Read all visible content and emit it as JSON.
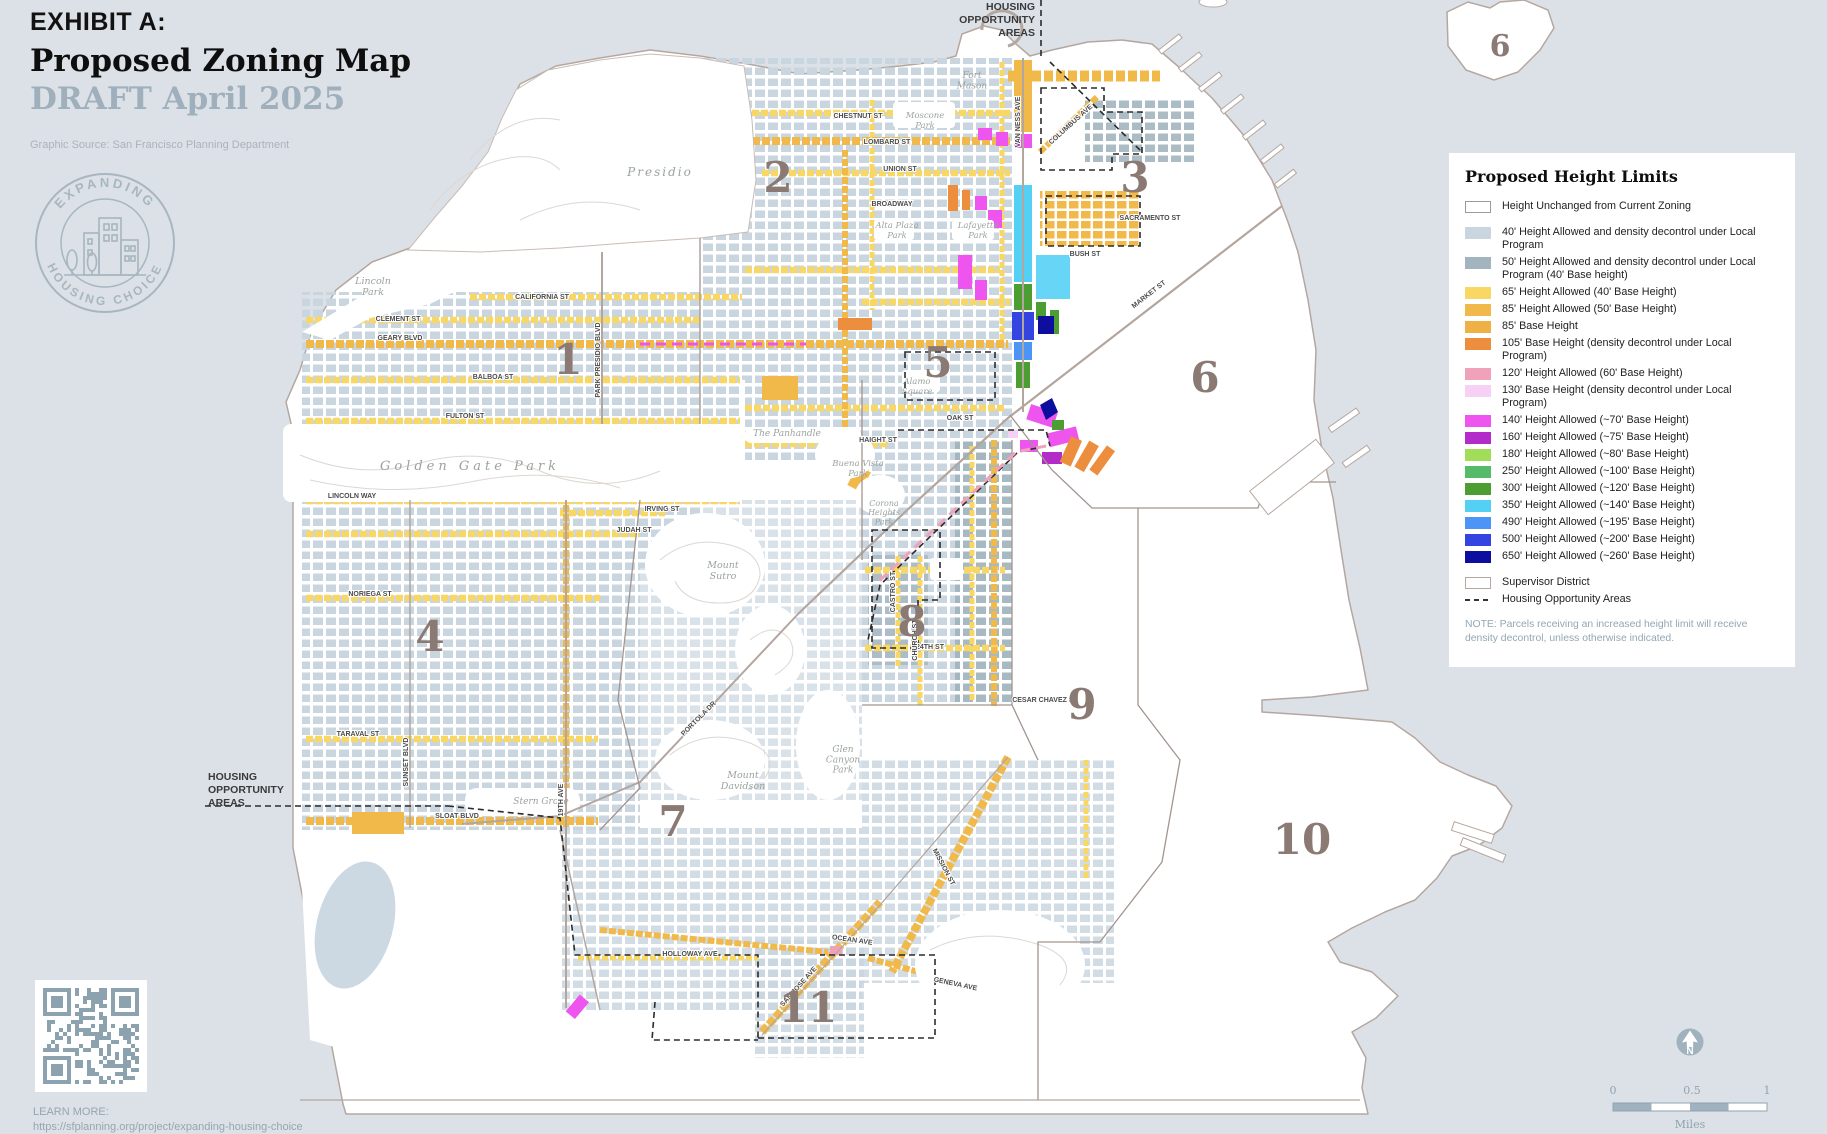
{
  "header": {
    "exhibit": "EXHIBIT A:",
    "title": "Proposed Zoning Map",
    "draft": "DRAFT April 2025",
    "source": "Graphic Source: San Francisco Planning Department"
  },
  "logo": {
    "top": "EXPANDING",
    "bottom": "HOUSING CHOICE"
  },
  "colors": {
    "water": "#dce1e7",
    "land": "#ffffff",
    "boundary": "#a3948e",
    "district_number": "#8a7a73",
    "draft_text": "#9fb0bc"
  },
  "legend": {
    "title": "Proposed Height Limits",
    "items": [
      {
        "label": "Height Unchanged from Current Zoning",
        "swatch": "outline",
        "color": "#ffffff",
        "gap_after": true
      },
      {
        "label": "40' Height Allowed and density decontrol under Local Program",
        "swatch": "fill",
        "color": "#c9d6e0"
      },
      {
        "label": "50' Height Allowed and density decontrol under Local Program (40' Base height)",
        "swatch": "fill",
        "color": "#a2b5bf"
      },
      {
        "label": "65' Height Allowed (40' Base Height)",
        "swatch": "fill",
        "color": "#f9d765"
      },
      {
        "label": "85' Height Allowed (50' Base Height)",
        "swatch": "fill",
        "color": "#f0b94a"
      },
      {
        "label": "85' Base Height",
        "swatch": "fill",
        "color": "#efb045"
      },
      {
        "label": "105' Base Height (density decontrol under Local Program)",
        "swatch": "fill",
        "color": "#ec8e3d"
      },
      {
        "label": "120' Height Allowed (60' Base Height)",
        "swatch": "fill",
        "color": "#f0a2ba"
      },
      {
        "label": "130' Base Height (density decontrol under Local Program)",
        "swatch": "fill",
        "color": "#f6d0f5"
      },
      {
        "label": "140' Height Allowed (~70' Base Height)",
        "swatch": "fill",
        "color": "#ee55ee"
      },
      {
        "label": "160' Height Allowed (~75' Base Height)",
        "swatch": "fill",
        "color": "#b32bc9"
      },
      {
        "label": "180' Height Allowed (~80' Base Height)",
        "swatch": "fill",
        "color": "#a2dd59"
      },
      {
        "label": "250' Height Allowed (~100' Base Height)",
        "swatch": "fill",
        "color": "#55bb6b"
      },
      {
        "label": "300' Height Allowed (~120' Base Height)",
        "swatch": "fill",
        "color": "#4d9e32"
      },
      {
        "label": "350' Height Allowed (~140' Base Height)",
        "swatch": "fill",
        "color": "#55d0f5"
      },
      {
        "label": "490' Height Allowed (~195' Base Height)",
        "swatch": "fill",
        "color": "#4d94f7"
      },
      {
        "label": "500' Height Allowed (~200' Base Height)",
        "swatch": "fill",
        "color": "#3444e0"
      },
      {
        "label": "650' Height Allowed (~260' Base Height)",
        "swatch": "fill",
        "color": "#0d0d9e",
        "gap_after": true
      },
      {
        "label": "Supervisor District",
        "swatch": "outline-brown",
        "color": "#ffffff"
      },
      {
        "label": "Housing Opportunity Areas",
        "swatch": "dash",
        "color": "#333333"
      }
    ],
    "note": "NOTE: Parcels receiving an increased height limit will receive density decontrol, unless otherwise indicated."
  },
  "districts": [
    {
      "n": "1",
      "x": 568,
      "y": 374
    },
    {
      "n": "2",
      "x": 778,
      "y": 192
    },
    {
      "n": "3",
      "x": 1135,
      "y": 192
    },
    {
      "n": "4",
      "x": 430,
      "y": 651
    },
    {
      "n": "5",
      "x": 938,
      "y": 377
    },
    {
      "n": "6",
      "x": 1205,
      "y": 392
    },
    {
      "n": "7",
      "x": 673,
      "y": 836
    },
    {
      "n": "8",
      "x": 912,
      "y": 636
    },
    {
      "n": "9",
      "x": 1082,
      "y": 719
    },
    {
      "n": "10",
      "x": 1302,
      "y": 854
    },
    {
      "n": "11",
      "x": 808,
      "y": 1022
    },
    {
      "n": "6",
      "x": 1500,
      "y": 56,
      "s": 30
    }
  ],
  "park_labels": [
    {
      "t": "Presidio",
      "x": 660,
      "y": 176,
      "s": 12,
      "ls": 2
    },
    {
      "t": "Lincoln|Park",
      "x": 373,
      "y": 284,
      "s": 9.5
    },
    {
      "t": "Golden  Gate  Park",
      "x": 470,
      "y": 470,
      "s": 13,
      "ls": 4
    },
    {
      "t": "Moscone|Park",
      "x": 925,
      "y": 118,
      "s": 8.5
    },
    {
      "t": "Fort|Mason",
      "x": 972,
      "y": 78,
      "s": 9
    },
    {
      "t": "Alta Plaza|Park",
      "x": 897,
      "y": 228,
      "s": 8.5
    },
    {
      "t": "Lafayette|Park",
      "x": 978,
      "y": 228,
      "s": 8.5
    },
    {
      "t": "Alamo|Square",
      "x": 917,
      "y": 384,
      "s": 8.5
    },
    {
      "t": "Buena Vista|Park",
      "x": 858,
      "y": 466,
      "s": 8.5
    },
    {
      "t": "Corona|Heights|Park",
      "x": 884,
      "y": 506,
      "s": 8
    },
    {
      "t": "The Panhandle",
      "x": 787,
      "y": 436,
      "s": 9
    },
    {
      "t": "Mount|Sutro",
      "x": 723,
      "y": 568,
      "s": 9.5
    },
    {
      "t": "Mount|Davidson",
      "x": 743,
      "y": 778,
      "s": 9.5
    },
    {
      "t": "Glen|Canyon|Park",
      "x": 843,
      "y": 752,
      "s": 9
    },
    {
      "t": "Stern Grove",
      "x": 541,
      "y": 804,
      "s": 9
    }
  ],
  "street_labels": [
    {
      "t": "CALIFORNIA ST",
      "x": 542,
      "y": 299,
      "a": 0
    },
    {
      "t": "CLEMENT ST",
      "x": 398,
      "y": 321,
      "a": 0
    },
    {
      "t": "GEARY BLVD",
      "x": 400,
      "y": 340,
      "a": 0
    },
    {
      "t": "BALBOA ST",
      "x": 493,
      "y": 379,
      "a": 0
    },
    {
      "t": "FULTON ST",
      "x": 465,
      "y": 418,
      "a": 0
    },
    {
      "t": "LINCOLN WAY",
      "x": 352,
      "y": 498,
      "a": 0
    },
    {
      "t": "IRVING ST",
      "x": 662,
      "y": 511,
      "a": 0
    },
    {
      "t": "JUDAH ST",
      "x": 634,
      "y": 532,
      "a": 0
    },
    {
      "t": "NORIEGA ST",
      "x": 370,
      "y": 596,
      "a": 0
    },
    {
      "t": "TARAVAL ST",
      "x": 358,
      "y": 736,
      "a": 0
    },
    {
      "t": "SLOAT BLVD",
      "x": 457,
      "y": 818,
      "a": 0
    },
    {
      "t": "CHESTNUT ST",
      "x": 858,
      "y": 118,
      "a": 0
    },
    {
      "t": "LOMBARD ST",
      "x": 887,
      "y": 144,
      "a": 0
    },
    {
      "t": "UNION ST",
      "x": 900,
      "y": 171,
      "a": 0
    },
    {
      "t": "BROADWAY",
      "x": 892,
      "y": 206,
      "a": 0
    },
    {
      "t": "COLUMBUS AVE",
      "x": 1072,
      "y": 126,
      "a": -42
    },
    {
      "t": "HAIGHT ST",
      "x": 878,
      "y": 442,
      "a": 0
    },
    {
      "t": "OAK ST",
      "x": 960,
      "y": 420,
      "a": 0
    },
    {
      "t": "BUSH ST",
      "x": 1085,
      "y": 256,
      "a": 0
    },
    {
      "t": "SACRAMENTO ST",
      "x": 1150,
      "y": 220,
      "a": 0
    },
    {
      "t": "MARKET ST",
      "x": 1150,
      "y": 296,
      "a": -38
    },
    {
      "t": "PORTOLA DR",
      "x": 700,
      "y": 720,
      "a": -45
    },
    {
      "t": "19TH AVE",
      "x": 563,
      "y": 800,
      "a": -90
    },
    {
      "t": "PARK PRESIDIO BLVD",
      "x": 600,
      "y": 360,
      "a": -90
    },
    {
      "t": "SUNSET BLVD",
      "x": 408,
      "y": 762,
      "a": -90
    },
    {
      "t": "VAN NESS AVE",
      "x": 1020,
      "y": 122,
      "a": -90
    },
    {
      "t": "MISSION ST",
      "x": 942,
      "y": 868,
      "a": 62
    },
    {
      "t": "OCEAN AVE",
      "x": 852,
      "y": 942,
      "a": 8
    },
    {
      "t": "GENEVA AVE",
      "x": 955,
      "y": 986,
      "a": 12
    },
    {
      "t": "CESAR CHAVEZ ST",
      "x": 1045,
      "y": 702,
      "a": 0
    },
    {
      "t": "24TH ST",
      "x": 930,
      "y": 649,
      "a": 0
    },
    {
      "t": "CHURCH ST",
      "x": 917,
      "y": 640,
      "a": -90
    },
    {
      "t": "CASTRO ST",
      "x": 895,
      "y": 592,
      "a": -90
    },
    {
      "t": "HOLLOWAY AVE",
      "x": 690,
      "y": 956,
      "a": 0
    },
    {
      "t": "SAN JOSE AVE",
      "x": 800,
      "y": 988,
      "a": -48
    }
  ],
  "hoa_label_top": {
    "lines": [
      "HOUSING",
      "OPPORTUNITY",
      "AREAS"
    ],
    "x": 1035,
    "y": 10
  },
  "hoa_label_west": {
    "lines": [
      "HOUSING",
      "OPPORTUNITY",
      "AREAS"
    ],
    "x": 208,
    "y": 780
  },
  "scalebar": {
    "ticks": [
      "0",
      "0.5",
      "1"
    ],
    "unit": "Miles"
  },
  "north_arrow": {
    "letter": "N"
  },
  "footer": {
    "learn_more": "LEARN MORE:",
    "url": "https://sfplanning.org/project/expanding-housing-choice"
  }
}
